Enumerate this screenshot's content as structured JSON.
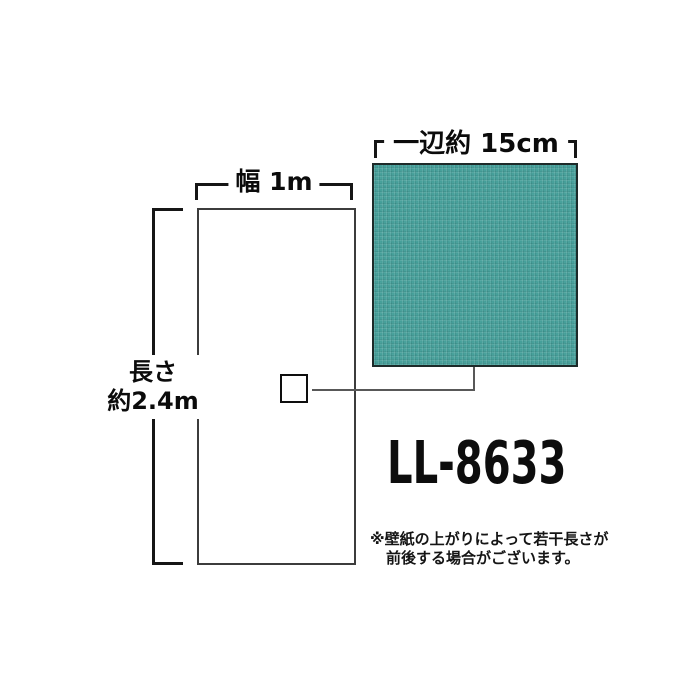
{
  "diagram": {
    "width_label": "幅 1m",
    "length_label_line1": "長さ",
    "length_label_line2": "約2.4m",
    "sample_label": "一辺約 15cm",
    "product_code": "LL-8633",
    "note_line1": "※壁紙の上がりによって若干長さが",
    "note_line2": "前後する場合がございます。"
  },
  "colors": {
    "swatch_teal": "#3a9d97",
    "bracket_black": "#161616",
    "connector_gray": "#585858"
  }
}
